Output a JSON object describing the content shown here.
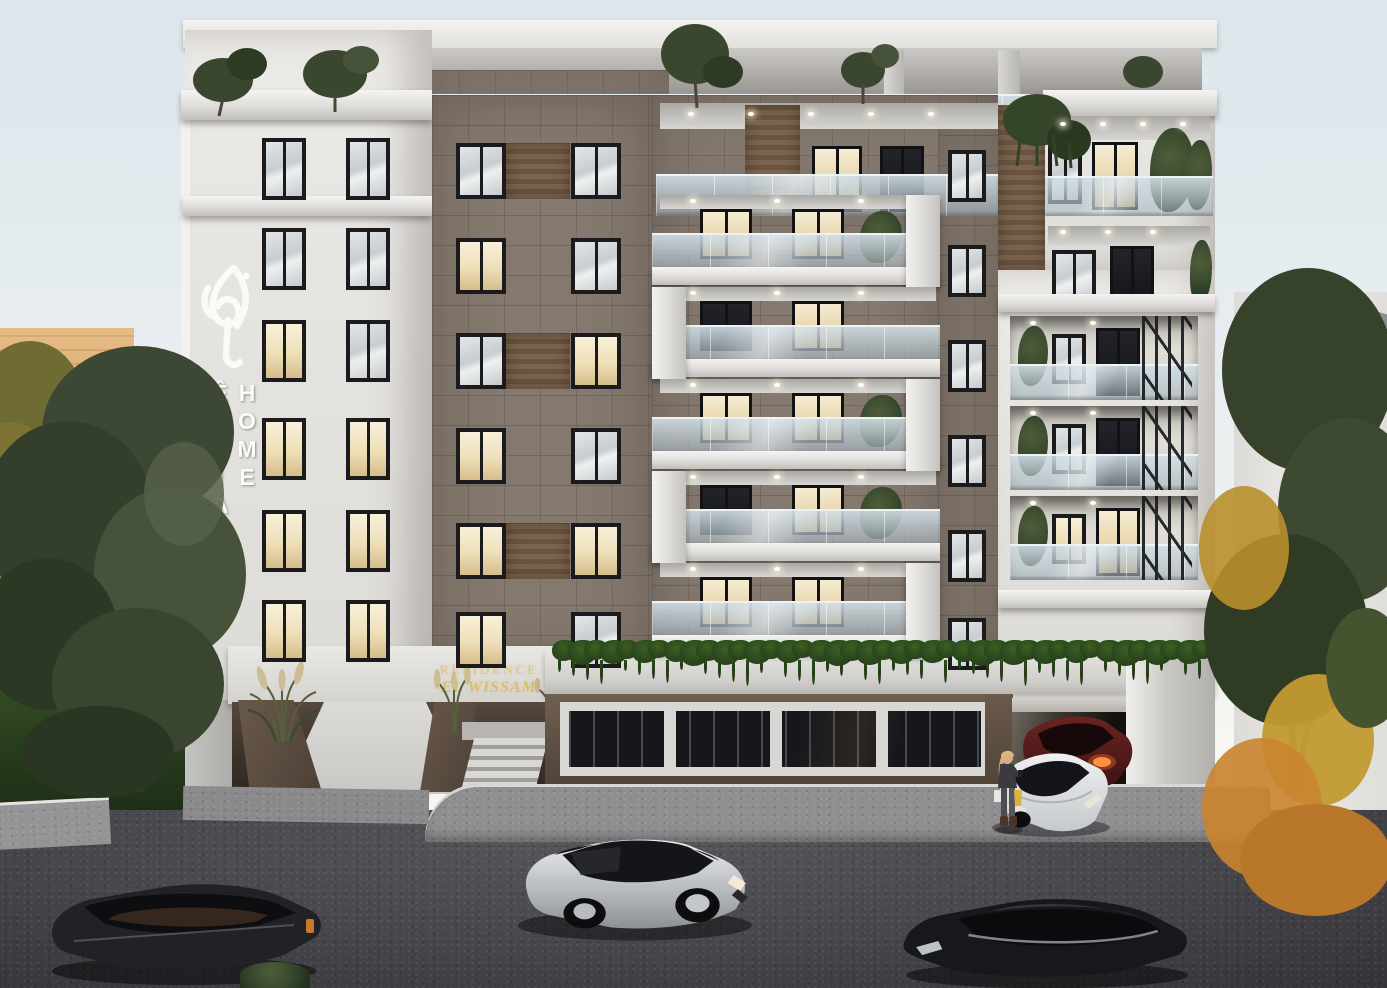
{
  "meta": {
    "scene": "architectural-exterior-render",
    "setting": "modern residential apartment building at dusk",
    "image_kind": "3D visualization"
  },
  "branding": {
    "logo_icon": "arabic-calligraphy-logo",
    "vertical_sign_text": "ÊDDIAR HOME",
    "entrance_sign": {
      "line1": "RESIDENCE",
      "line2": "EL WISSAM"
    }
  },
  "building": {
    "floors_above_ground": 7,
    "left_wing": {
      "window_rows": 6,
      "window_cols": 2,
      "facade": "white"
    },
    "mid_section": {
      "window_rows": 6,
      "facade": "brown tile",
      "accent": "wood panels"
    },
    "balcony_stack_floors": 5,
    "right_wing": {
      "recessed_balcony_floors": 3,
      "accent": "black decorative branch screen"
    },
    "ground_floor": {
      "entrance": "ramp with ornamental grass planters and side stairs",
      "garage": "underground parking exit",
      "greenery": "cascading ivy over white ledge"
    }
  },
  "environment": {
    "left": "olive trees, lawn and an orange brick building",
    "right": "autumn trees and a white building with grey roof",
    "foreground": "asphalt street with parked cars",
    "sky": "pale dusk sky"
  },
  "vehicles": [
    {
      "name": "black-suv",
      "color": "#212226",
      "position": "bottom left street"
    },
    {
      "name": "silver-suv",
      "color": "#c3c6c9",
      "position": "center street"
    },
    {
      "name": "black-sedan",
      "color": "#17181b",
      "position": "bottom right street"
    },
    {
      "name": "white-sedan",
      "color": "#e0e2e3",
      "position": "exiting garage"
    },
    {
      "name": "dark-red-sedan",
      "color": "#5a1f1d",
      "position": "garage ramp, headlights on"
    }
  ],
  "people": [
    {
      "name": "woman-with-shopping-bags",
      "hair": "blonde",
      "jacket_color": "#3a3a40",
      "bag_color": "#d8b43e",
      "position": "beside white sedan"
    }
  ],
  "palette": {
    "sky_top": "#dde7ed",
    "sky_bottom": "#f5f6f3",
    "white_facade": "#e8e7e4",
    "brown_tile": "#85796f",
    "wood_accent": "#74604c",
    "window_frame": "#1b1b1d",
    "warm_window_glow": "#f3e8cd",
    "glass_railing": "#c9d6dd",
    "ground_floor_brown": "#6a594c",
    "gold_sign": "#dcc083",
    "asphalt": "#3f3f43",
    "sidewalk": "#909092",
    "lawn": "#2d4320",
    "olive_foliage": "#3e4a32",
    "autumn_foliage": "#c69a2e"
  }
}
